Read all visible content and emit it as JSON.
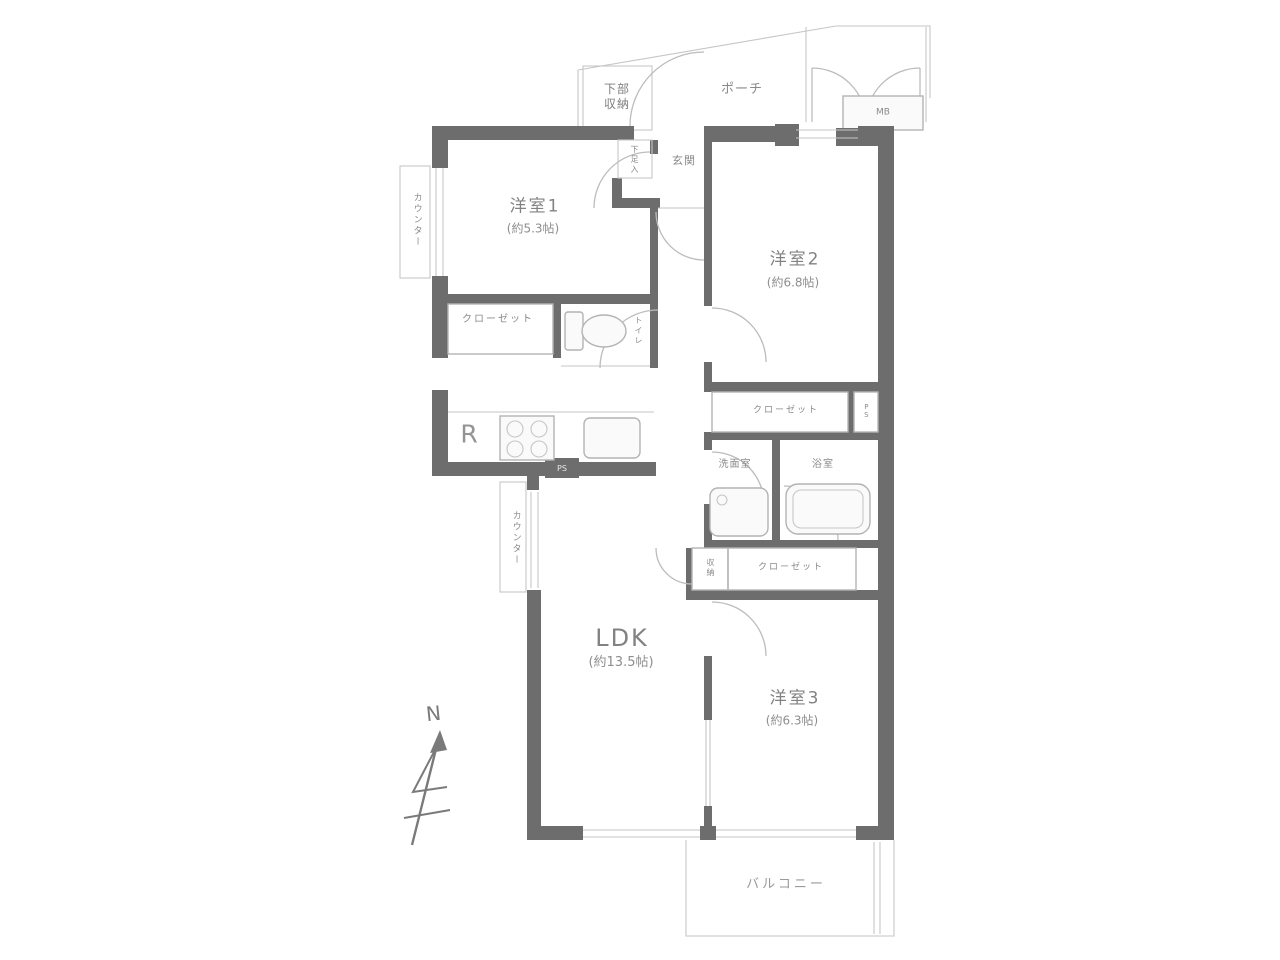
{
  "plan": {
    "rooms": {
      "western1": {
        "name": "洋室1",
        "size": "(約5.3帖)"
      },
      "western2": {
        "name": "洋室2",
        "size": "(約6.8帖)"
      },
      "western3": {
        "name": "洋室3",
        "size": "(約6.3帖)"
      },
      "ldk": {
        "name": "LDK",
        "size": "(約13.5帖)"
      }
    },
    "labels": {
      "balcony": "バルコニー",
      "porch": "ポーチ",
      "entrance": "玄関",
      "lower_storage_line1": "下部",
      "lower_storage_line2": "収納",
      "shoe_cabinet": "下足入",
      "toilet": "トイレ",
      "closet1": "クローゼット",
      "closet2": "クローゼット",
      "closet3": "クローゼット",
      "washroom": "洗面室",
      "bathroom": "浴室",
      "storage": "収納",
      "counter1": "カウンター",
      "counter2": "カウンター",
      "meter_box": "MB",
      "pipe_space_kitchen": "PS",
      "pipe_space": "PS",
      "refrigerator": "R",
      "north": "N"
    },
    "colors": {
      "wall": "#6d6d6d",
      "line": "#b3b3b3",
      "label": "#8a8a8a"
    }
  }
}
